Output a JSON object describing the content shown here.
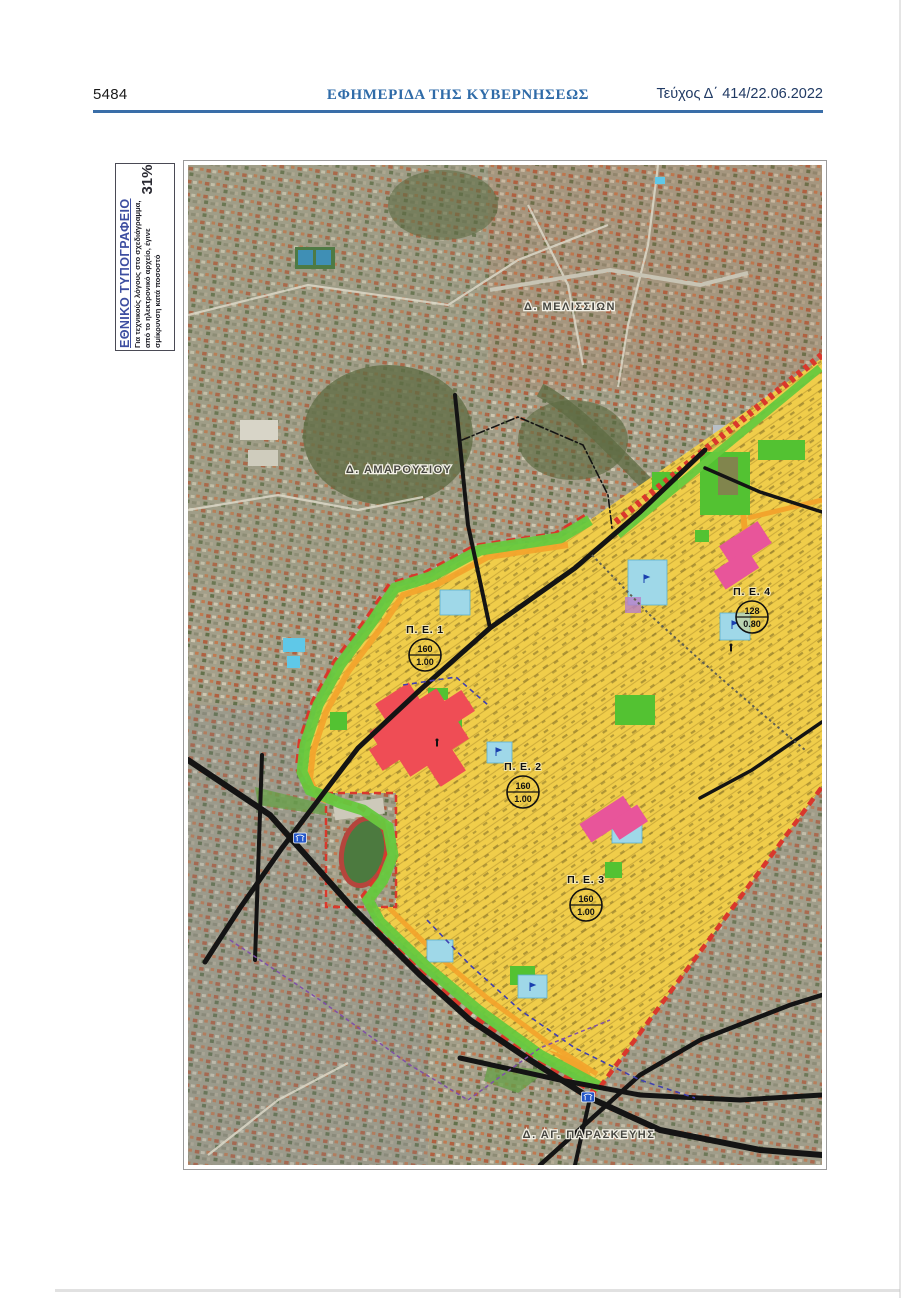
{
  "page": {
    "number": "5484",
    "header_title": "ΕΦΗΜΕΡΙΔΑ ΤΗΣ ΚΥΒΕΡΝΗΣΕΩΣ",
    "issue": "Τεύχος Δ΄ 414/22.06.2022"
  },
  "printing_note": {
    "title": "ΕΘΝΙΚΟ ΤΥΠΟΓΡΑΦΕΙΟ",
    "line1": "Για τεχνικούς λόγους στο σχεδιάγραμμα,",
    "line2": "από το ηλεκτρονικό αρχείο, έγινε",
    "line3": "σμίκρυνση κατά ποσοστό",
    "percentage": "31%"
  },
  "map": {
    "municipality_labels": [
      "Δ. ΜΕΛΙΣΣΙΩΝ",
      "Δ. ΑΜΑΡΟΥΣΙΟΥ",
      "Δ. ΑΓ. ΠΑΡΑΣΚΕΥΗΣ"
    ],
    "planning_units": [
      {
        "label": "Π. Ε. 1",
        "numerator": "160",
        "denominator": "1.00"
      },
      {
        "label": "Π. Ε. 2",
        "numerator": "160",
        "denominator": "1.00"
      },
      {
        "label": "Π. Ε. 3",
        "numerator": "160",
        "denominator": "1.00"
      },
      {
        "label": "Π. Ε. 4",
        "numerator": "128",
        "denominator": "0.80"
      }
    ],
    "colors": {
      "header_blue": "#3a6ea8",
      "note_blue": "#3d4ea0",
      "zone_yellow": "#f0cd4a",
      "zone_red": "#ef4d55",
      "zone_pink": "#e8559a",
      "zone_green": "#53c232",
      "band_green": "#66c93e",
      "boundary_red": "#d9382c",
      "strip_orange": "#f2a42c",
      "school_blue": "#9fd8e8",
      "road_black": "#141414"
    }
  }
}
